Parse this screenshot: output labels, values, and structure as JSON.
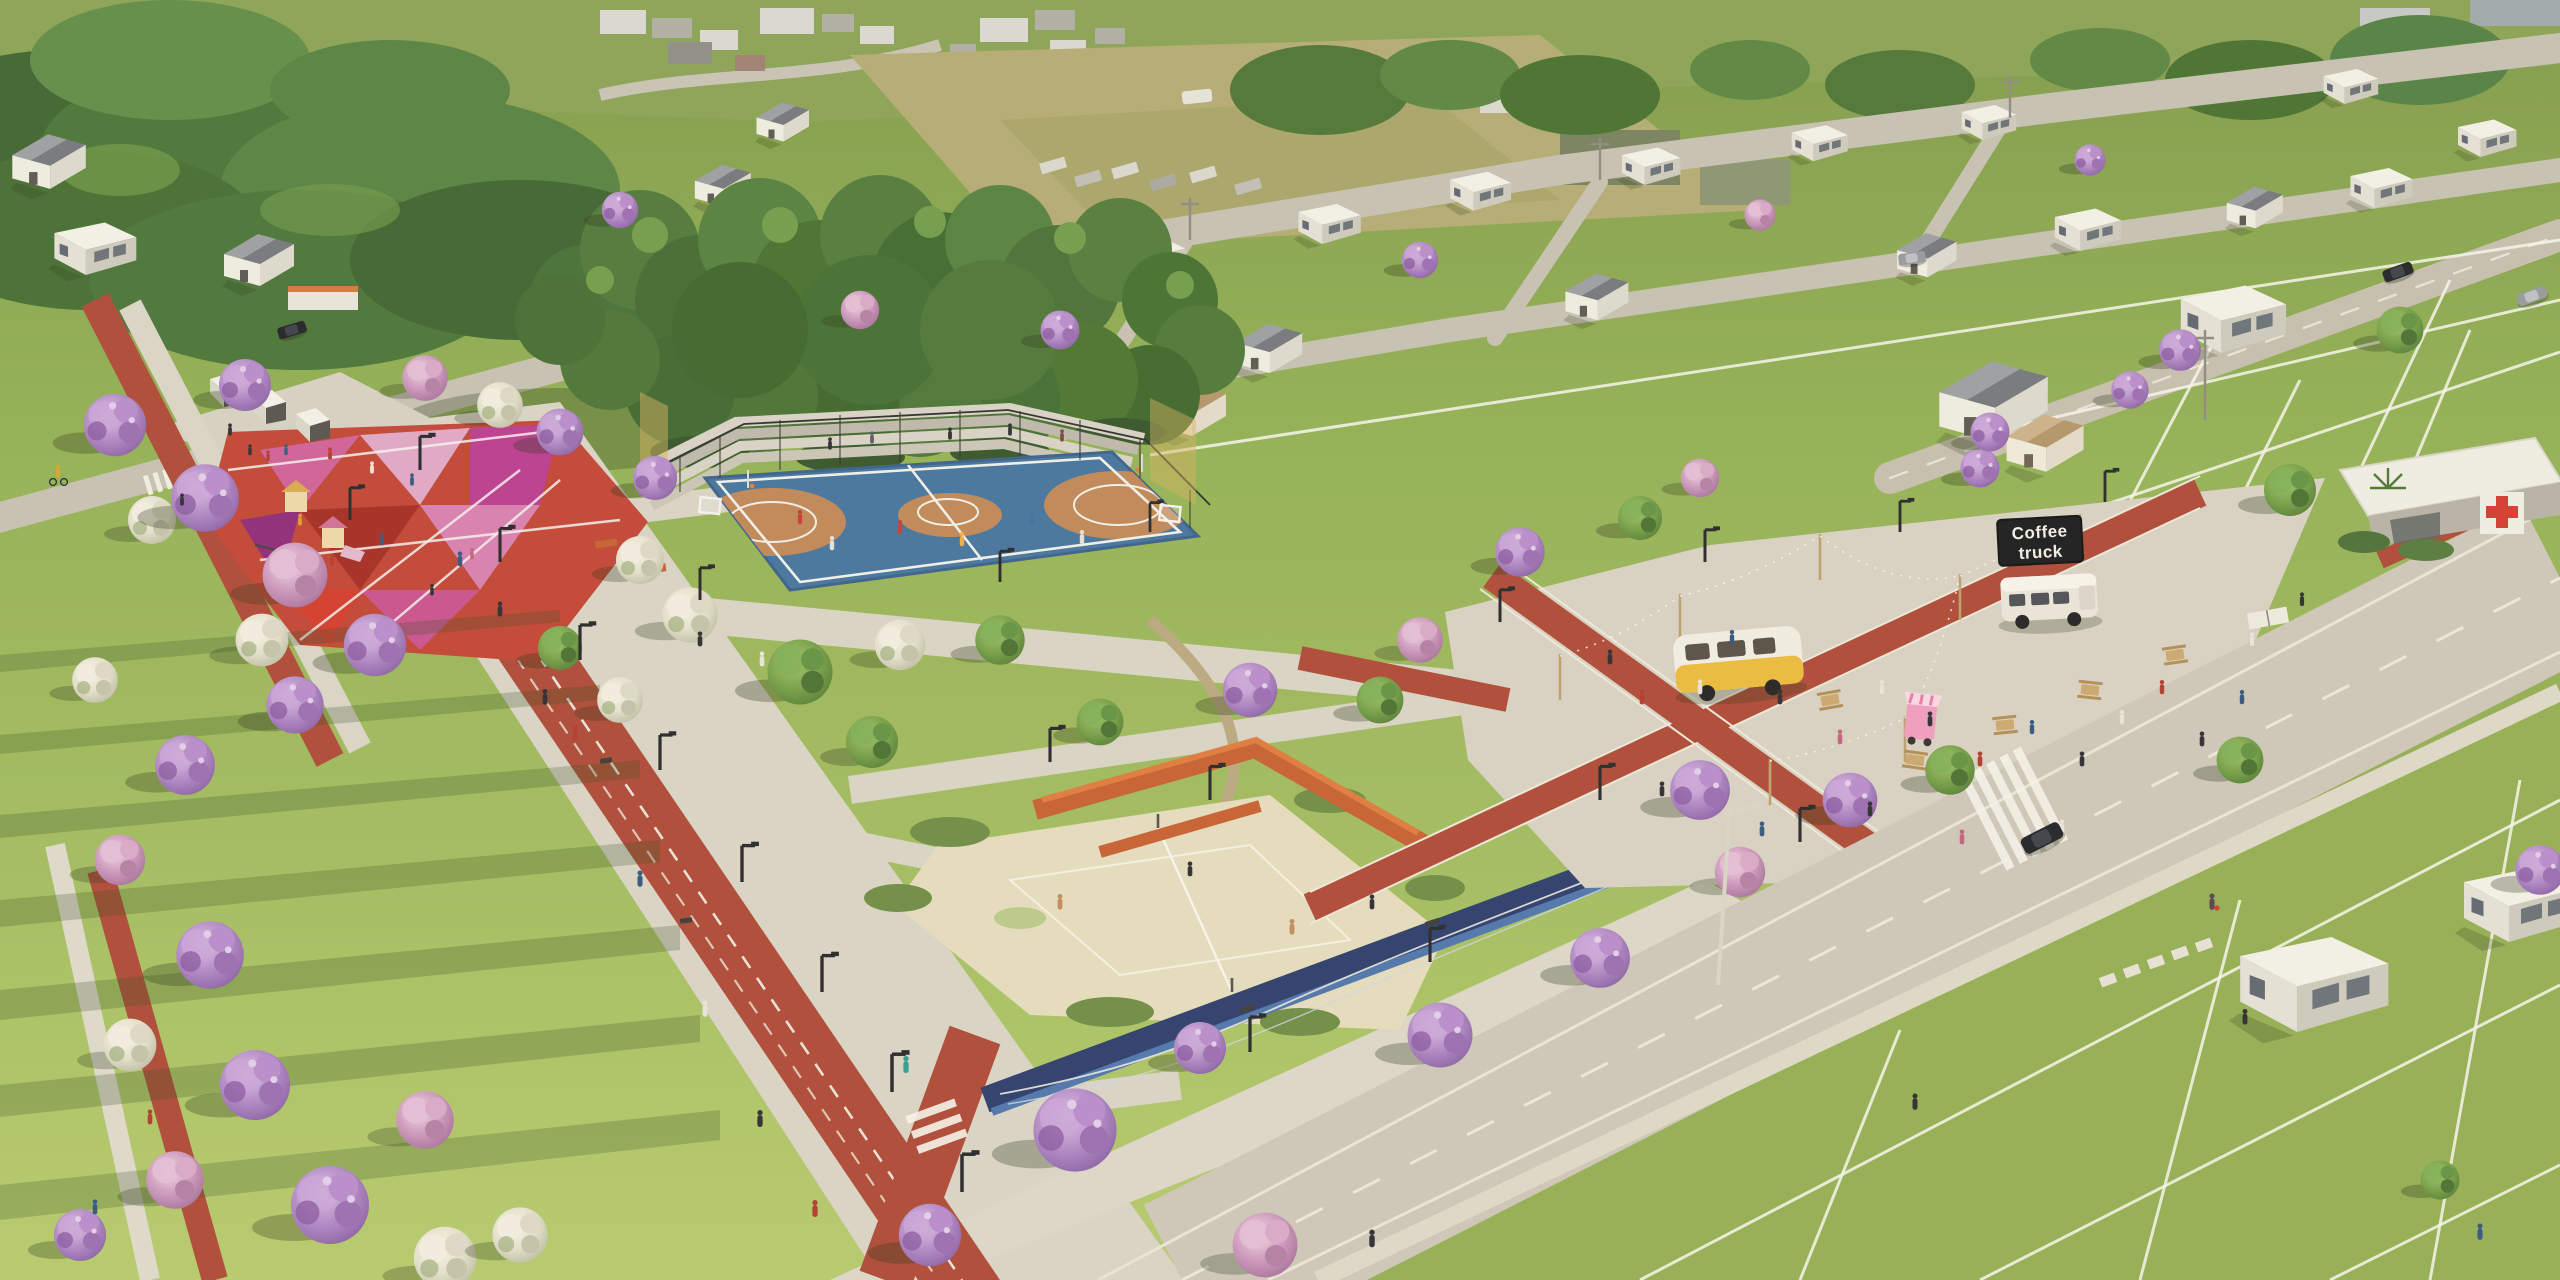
{
  "signs": {
    "coffee_truck_line1": "Coffee",
    "coffee_truck_line2": "truck"
  },
  "scene": {
    "description": "Sunlit aerial architectural rendering of a landscaped linear park inside a residential land development, surrounded by model homes, lawns with lot lines and roads",
    "areas": [
      {
        "name": "distant-town"
      },
      {
        "name": "woodland-top-left"
      },
      {
        "name": "farm-field-with-parked-trucks"
      },
      {
        "name": "residential-neighborhood"
      },
      {
        "name": "preserved-forest-grove"
      },
      {
        "name": "multisport-court",
        "surface_blue": "#44739d",
        "surface_clay": "#bf8656"
      },
      {
        "name": "geometric-playground",
        "colors": [
          "#c04434",
          "#cf5f97",
          "#e0a7c4",
          "#a42c22"
        ]
      },
      {
        "name": "market-kiosks"
      },
      {
        "name": "jogging-track",
        "color": "#ad4936"
      },
      {
        "name": "central-meadow"
      },
      {
        "name": "beach-volleyball-court",
        "sand": "#e4dbbd"
      },
      {
        "name": "orange-bleachers",
        "color": "#c65f30"
      },
      {
        "name": "food-truck-plaza"
      },
      {
        "name": "coffee-truck"
      },
      {
        "name": "yellow-camper-trailer"
      },
      {
        "name": "ice-cream-cart"
      },
      {
        "name": "main-avenue"
      },
      {
        "name": "health-clinic",
        "cross_color": "#d23a2e"
      },
      {
        "name": "residential-lots-with-white-lines"
      },
      {
        "name": "wave-mural",
        "color": "#2c3d6b"
      },
      {
        "name": "promenade"
      }
    ],
    "palette": {
      "lawn": "#9cb858",
      "forest": "#47703a",
      "blossom_purple": "#a87fbe",
      "blossom_white": "#e7e2d2",
      "track_red": "#ad4936",
      "court_blue": "#44739d",
      "clay": "#bf8656",
      "concrete": "#d7d2c4",
      "sand": "#e4dbbd",
      "bench_orange": "#c65f30",
      "mural_navy": "#2c3d6b"
    }
  }
}
